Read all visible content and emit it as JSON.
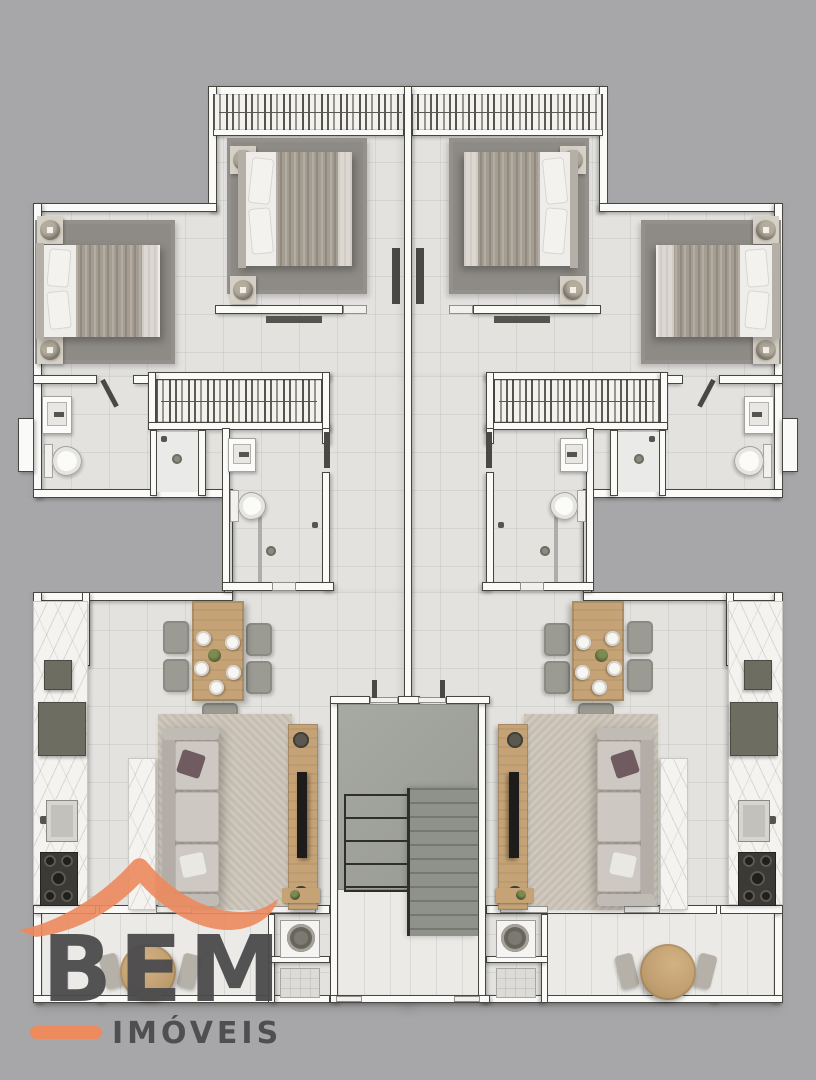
{
  "scene": {
    "type": "residential floor plan render, two mirrored apartment units, top-down view",
    "units_count": 2,
    "unit_rooms": [
      "bedroom-outer",
      "bedroom-center",
      "wardrobe",
      "walk-in-closet",
      "bathroom-outer",
      "bathroom-inner",
      "shower",
      "kitchen",
      "dining-area",
      "living-room",
      "laundry",
      "balcony",
      "stair-hall"
    ]
  },
  "logo": {
    "brand": "BEM",
    "suffix": "IMÓVEIS"
  },
  "colors": {
    "bg": "#a7a7a9",
    "floor": "#e3e2df",
    "wall": "#fafaf8",
    "wallEdge": "#47463f",
    "rugDark": "#8e8b86",
    "rugBeige": "#cdc5b9",
    "wood": "#c5a376",
    "sofa": "#c7c3bc",
    "sofaBack": "#b2aea7",
    "mattress": "#efede9",
    "duvet": "#a59d92",
    "pillowAccent": "#6f5b60",
    "chair": "#9b9b94",
    "concrete": "#a1a49c",
    "concreteDark": "#8e928a",
    "appliance": "#6e6d62",
    "stove": "#3b3a36",
    "marble": "#f4f3f0",
    "fixture": "#fbfbf9",
    "leaf": "#4a4844",
    "green": "#7d8b50",
    "tv": "#1d1c1a",
    "accent": "#ed8a5e",
    "logoText": "#4b4b4d"
  }
}
